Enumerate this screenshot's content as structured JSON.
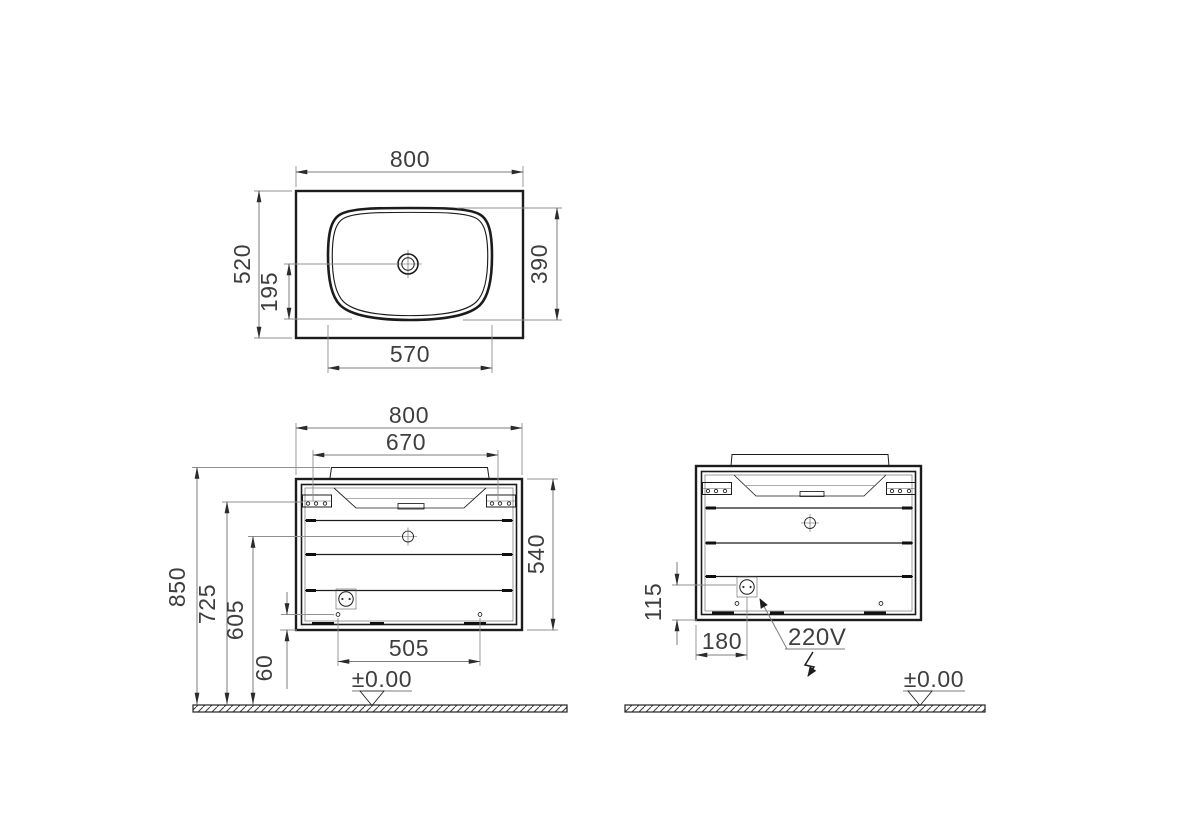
{
  "top_view": {
    "overall_width": "800",
    "overall_depth": "520",
    "drain_to_front": "195",
    "basin_depth": "390",
    "basin_width": "570"
  },
  "front_view": {
    "overall_width": "800",
    "bracket_span": "670",
    "height_to_rim": "850",
    "height_to_bracket": "725",
    "height_to_drain": "605",
    "hole_offset": "60",
    "hole_span": "505",
    "cabinet_height": "540",
    "floor_level": "±0.00"
  },
  "back_view": {
    "socket_height": "115",
    "socket_offset": "180",
    "socket_voltage": "220V",
    "floor_level": "±0.00"
  }
}
